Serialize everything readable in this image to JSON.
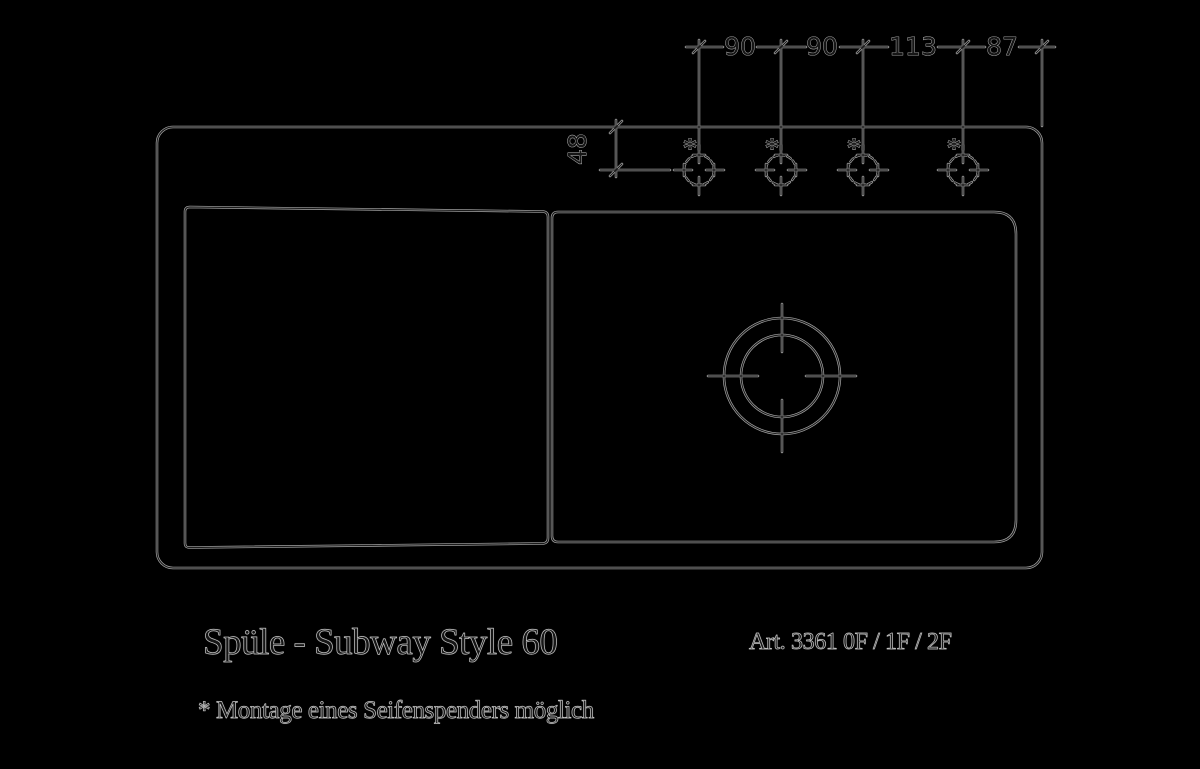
{
  "dimensions": {
    "top": [
      "90",
      "90",
      "113",
      "87"
    ],
    "side": "48",
    "hole_marker": "*"
  },
  "footer": {
    "title": "Spüle - Subway Style 60",
    "article": "Art. 3361 0F / 1F / 2F",
    "note": "* Montage eines Seifenspenders möglich"
  },
  "colors": {
    "background": "#000000",
    "line_halo": "#a9a9a9",
    "line_core": "#1a1a1a",
    "text_fill": "#161616",
    "text_outline": "#c2c2c2"
  }
}
